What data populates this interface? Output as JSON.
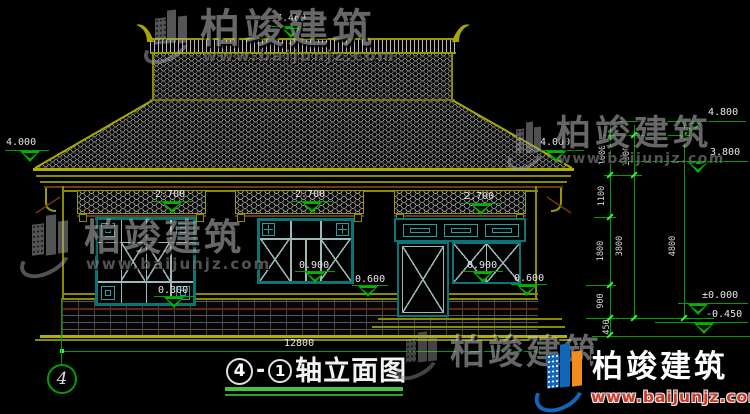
{
  "drawing": {
    "title": {
      "axis_start": "4",
      "separator": "-",
      "axis_end": "1",
      "name": "轴立面图"
    },
    "grid_bubble_left": "4",
    "overall_width": "12800"
  },
  "levels": {
    "ridge": "7.469",
    "eave_left": "4.000",
    "eave_right": "4.000",
    "roof_high": "4.800",
    "roof_low": "3.800",
    "ground": "±0.000",
    "site": "-0.450",
    "canopy_1": "2.700",
    "canopy_2": "2.700",
    "canopy_3": "2.700",
    "window_sill_low": "0.300",
    "window_sill_mid": "0.900",
    "window_sill_right": "0.900",
    "ledge_mid": "0.600",
    "ledge_right": "0.600"
  },
  "dim_chains": {
    "inner": [
      "1000",
      "1100",
      "1800",
      "900",
      "450"
    ],
    "middle": [
      "1000",
      "3800"
    ],
    "outer": [
      "4800"
    ]
  },
  "watermark": {
    "brand": "柏竣建筑",
    "site": "www.baijunjz.com"
  }
}
